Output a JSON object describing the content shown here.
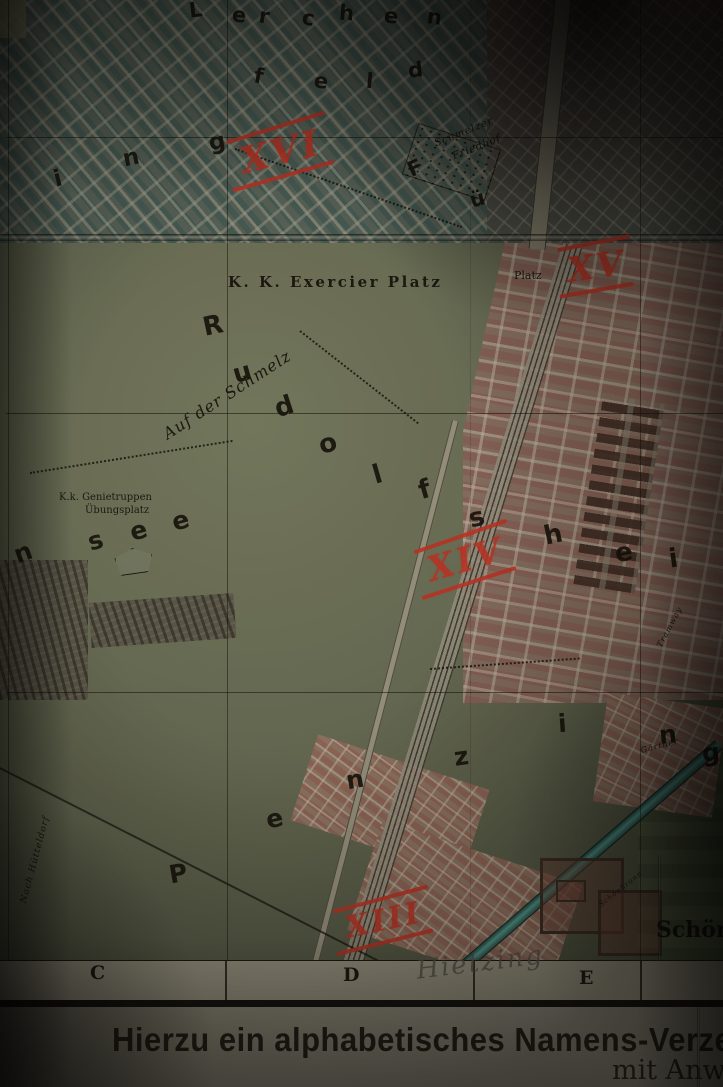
{
  "margin": {
    "line1": "Hierzu ein alphabetisches Namens-Verze",
    "line2": "mit Anw"
  },
  "map": {
    "colors": {
      "annotation_red": "#c23527",
      "water_teal": "#57a195",
      "block_pink": "#a0655a",
      "block_teal": "#55635c",
      "field_green": "#787d62",
      "paper": "#9e9a88",
      "ink": "#16130e"
    },
    "district_numbers": [
      {
        "text": "XVI",
        "x": 240,
        "y": 134,
        "size": 36,
        "rot": -14
      },
      {
        "text": "XV",
        "x": 567,
        "y": 250,
        "size": 34,
        "rot": -8
      },
      {
        "text": "XIV",
        "x": 427,
        "y": 543,
        "size": 34,
        "rot": -16
      },
      {
        "text": "XIII",
        "x": 345,
        "y": 906,
        "size": 30,
        "rot": -12
      }
    ],
    "letter_groups": [
      {
        "name": "lerchen",
        "size": 21,
        "letters": [
          {
            "ch": "L",
            "x": 189,
            "y": 0,
            "rot": -6
          },
          {
            "ch": "e",
            "x": 232,
            "y": 5,
            "rot": 6
          },
          {
            "ch": "r",
            "x": 259,
            "y": 6,
            "rot": 8
          },
          {
            "ch": "c",
            "x": 302,
            "y": 8,
            "rot": 10
          },
          {
            "ch": "h",
            "x": 339,
            "y": 3,
            "rot": 4
          },
          {
            "ch": "e",
            "x": 384,
            "y": 6,
            "rot": 6
          },
          {
            "ch": "n",
            "x": 427,
            "y": 7,
            "rot": 8
          }
        ]
      },
      {
        "name": "feld",
        "size": 21,
        "letters": [
          {
            "ch": "f",
            "x": 254,
            "y": 66,
            "rot": 10
          },
          {
            "ch": "e",
            "x": 314,
            "y": 71,
            "rot": 8
          },
          {
            "ch": "l",
            "x": 366,
            "y": 71,
            "rot": 5
          },
          {
            "ch": "d",
            "x": 408,
            "y": 60,
            "rot": -6
          }
        ]
      },
      {
        "name": "ing",
        "size": 23,
        "letters": [
          {
            "ch": "i",
            "x": 54,
            "y": 168,
            "rot": -14
          },
          {
            "ch": "n",
            "x": 123,
            "y": 147,
            "rot": -12
          },
          {
            "ch": "g",
            "x": 209,
            "y": 131,
            "rot": -10
          }
        ]
      },
      {
        "name": "fuenf",
        "size": 21,
        "letters": [
          {
            "ch": "F",
            "x": 408,
            "y": 158,
            "rot": -24
          },
          {
            "ch": "ü",
            "x": 470,
            "y": 189,
            "rot": -16
          }
        ]
      },
      {
        "name": "rudolfsheim",
        "size": 26,
        "letters": [
          {
            "ch": "R",
            "x": 203,
            "y": 313,
            "rot": -12
          },
          {
            "ch": "u",
            "x": 233,
            "y": 360,
            "rot": -16
          },
          {
            "ch": "d",
            "x": 275,
            "y": 394,
            "rot": -18
          },
          {
            "ch": "o",
            "x": 319,
            "y": 431,
            "rot": -18
          },
          {
            "ch": "l",
            "x": 373,
            "y": 462,
            "rot": -16
          },
          {
            "ch": "f",
            "x": 419,
            "y": 477,
            "rot": -16
          },
          {
            "ch": "s",
            "x": 469,
            "y": 505,
            "rot": -14
          },
          {
            "ch": "h",
            "x": 544,
            "y": 522,
            "rot": -12
          },
          {
            "ch": "e",
            "x": 615,
            "y": 540,
            "rot": -10
          },
          {
            "ch": "i",
            "x": 669,
            "y": 546,
            "rot": -8
          }
        ]
      },
      {
        "name": "ensee",
        "size": 25,
        "letters": [
          {
            "ch": "n",
            "x": 14,
            "y": 540,
            "rot": -20
          },
          {
            "ch": "s",
            "x": 88,
            "y": 528,
            "rot": -16
          },
          {
            "ch": "e",
            "x": 130,
            "y": 518,
            "rot": -15
          },
          {
            "ch": "e",
            "x": 172,
            "y": 508,
            "rot": -15
          }
        ]
      },
      {
        "name": "penzing",
        "size": 25,
        "letters": [
          {
            "ch": "P",
            "x": 169,
            "y": 861,
            "rot": -10
          },
          {
            "ch": "e",
            "x": 266,
            "y": 806,
            "rot": -12
          },
          {
            "ch": "n",
            "x": 346,
            "y": 767,
            "rot": -10
          },
          {
            "ch": "z",
            "x": 454,
            "y": 744,
            "rot": -8
          },
          {
            "ch": "i",
            "x": 558,
            "y": 711,
            "rot": -4
          },
          {
            "ch": "n",
            "x": 659,
            "y": 722,
            "rot": -5
          },
          {
            "ch": "g",
            "x": 702,
            "y": 740,
            "rot": -5
          }
        ]
      }
    ],
    "labels": [
      {
        "text": "K. K. Exercier Platz",
        "x": 228,
        "y": 274,
        "size": 15,
        "rot": 0,
        "cls": "spaced"
      },
      {
        "text": "Platz",
        "x": 514,
        "y": 270,
        "size": 11,
        "rot": 0,
        "cls": ""
      },
      {
        "text": "Auf der Schmelz",
        "x": 160,
        "y": 428,
        "size": 16,
        "rot": -33,
        "cls": "cursive"
      },
      {
        "text": "K.k. Genietruppen",
        "x": 59,
        "y": 492,
        "size": 10,
        "rot": 0,
        "cls": ""
      },
      {
        "text": "Übungsplatz",
        "x": 85,
        "y": 505,
        "size": 10,
        "rot": 0,
        "cls": ""
      },
      {
        "text": "Schmelzer",
        "x": 433,
        "y": 139,
        "size": 10,
        "rot": -22,
        "cls": "cursive"
      },
      {
        "text": "Friedhof",
        "x": 451,
        "y": 152,
        "size": 10,
        "rot": -22,
        "cls": "cursive"
      },
      {
        "text": "Schönb",
        "x": 656,
        "y": 918,
        "size": 22,
        "rot": 0,
        "cls": "serifbig"
      },
      {
        "text": "Schönbrunn",
        "x": 598,
        "y": 903,
        "size": 7,
        "rot": -38,
        "cls": "cursive"
      },
      {
        "text": "Nach Hütteldorf",
        "x": 20,
        "y": 902,
        "size": 9,
        "rot": -75,
        "cls": "cursive"
      },
      {
        "text": "Tramway",
        "x": 656,
        "y": 645,
        "size": 8,
        "rot": -62,
        "cls": "cursive"
      },
      {
        "text": "Gärtner",
        "x": 640,
        "y": 747,
        "size": 8,
        "rot": -14,
        "cls": "cursive"
      }
    ],
    "grid_letters": [
      {
        "text": "C",
        "x": 90,
        "y": 962,
        "size": 19
      },
      {
        "text": "D",
        "x": 343,
        "y": 964,
        "size": 19
      },
      {
        "text": "E",
        "x": 579,
        "y": 967,
        "size": 19
      }
    ],
    "pencil_note": {
      "text": "Hietzing"
    }
  }
}
